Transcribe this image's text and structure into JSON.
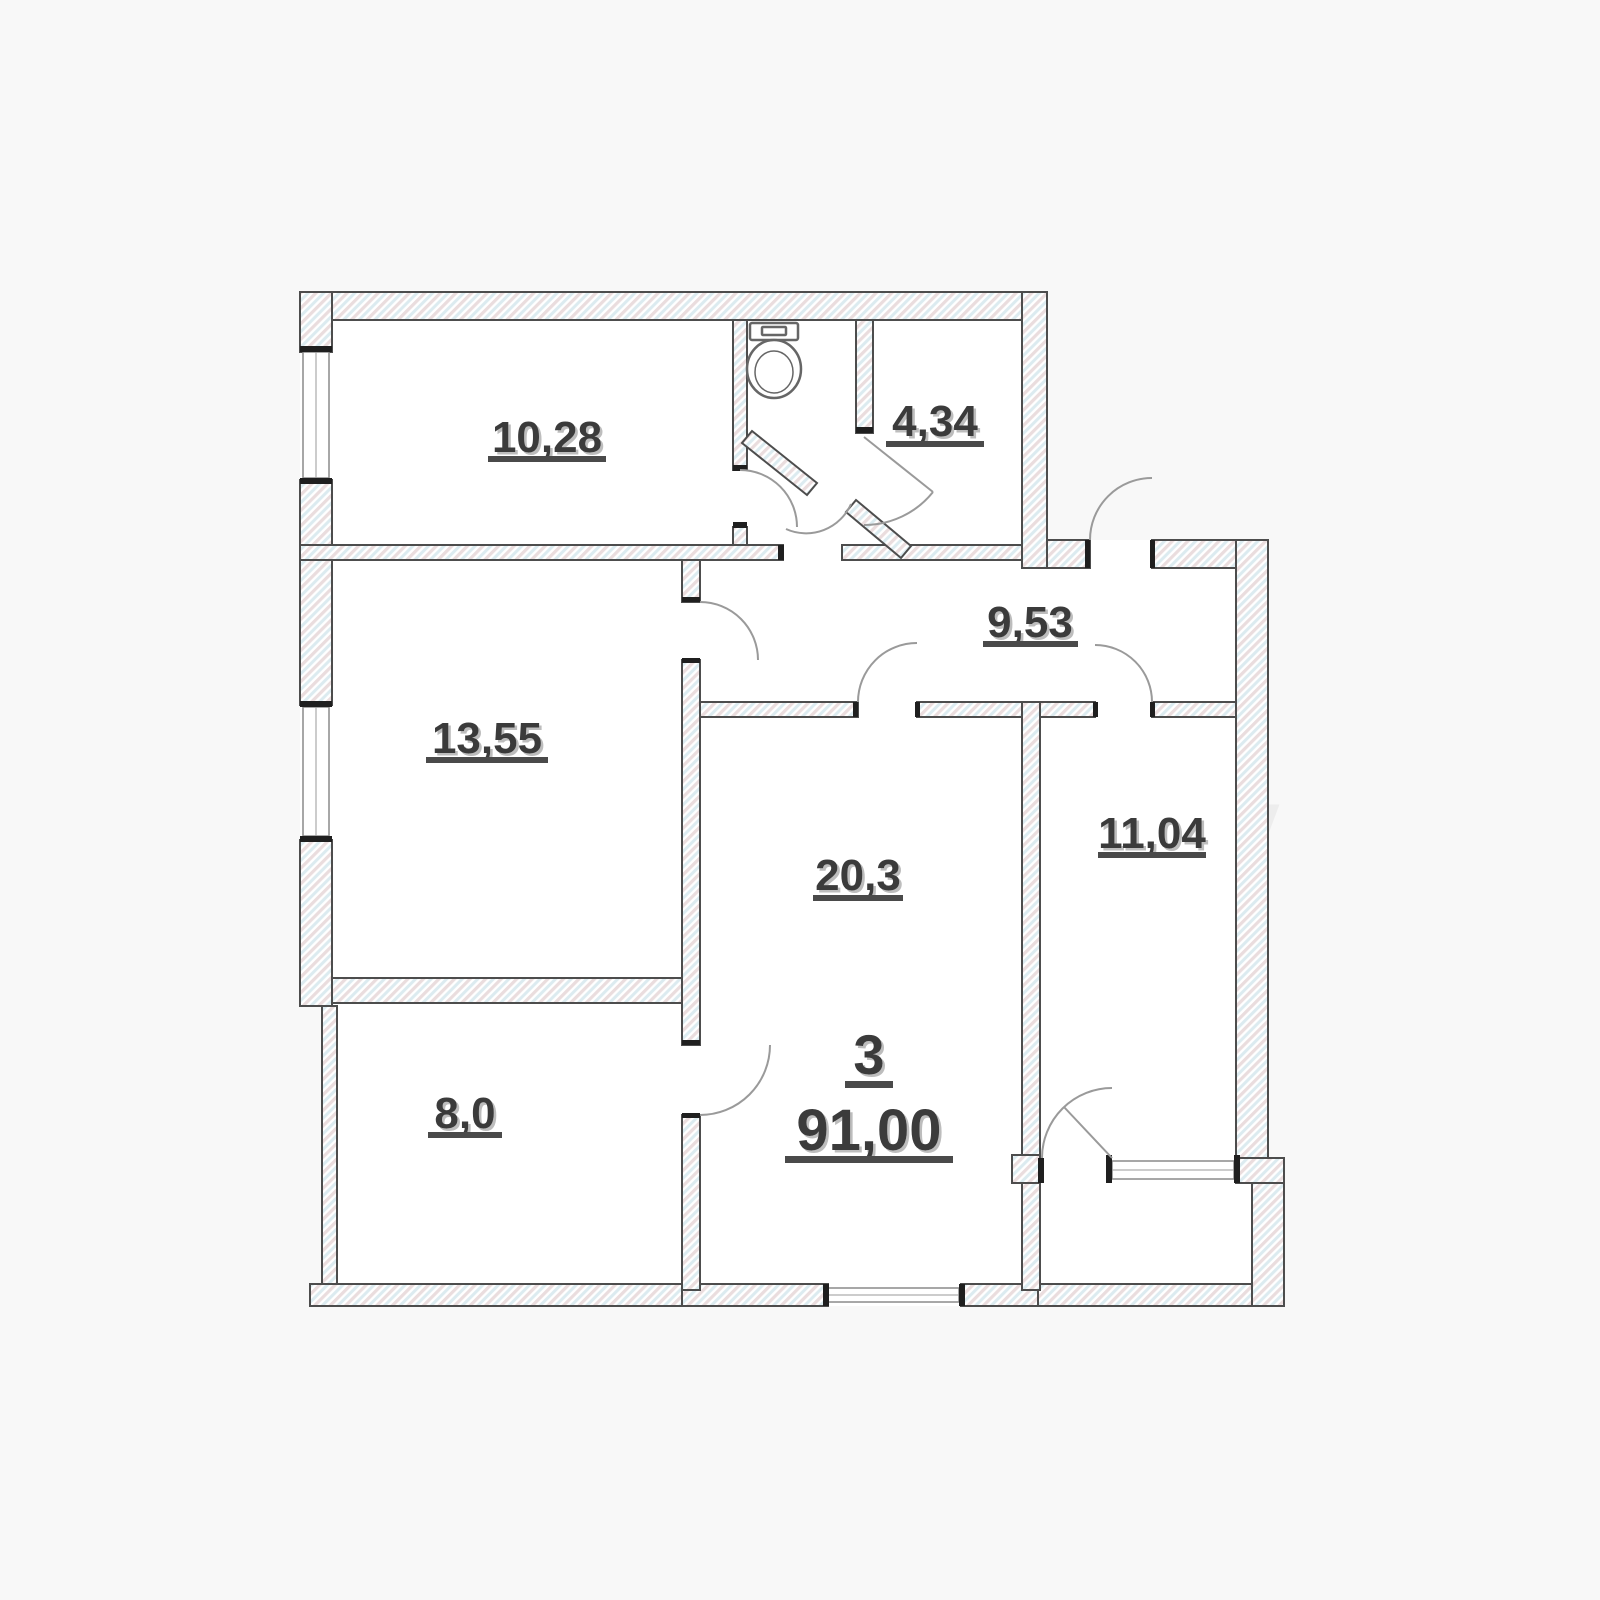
{
  "plan": {
    "apartment": {
      "number": "3",
      "total_area": "91,00"
    },
    "rooms": [
      {
        "key": "bedroom-top",
        "label": "10,28"
      },
      {
        "key": "bathroom",
        "label": "4,34"
      },
      {
        "key": "hallway",
        "label": "9,53"
      },
      {
        "key": "bedroom-left",
        "label": "13,55"
      },
      {
        "key": "living-room",
        "label": "20,3"
      },
      {
        "key": "bedroom-right",
        "label": "11,04"
      },
      {
        "key": "kitchen",
        "label": "8,0"
      }
    ],
    "watermark": {
      "text": "moby"
    },
    "colors": {
      "background": "#f8f8f8",
      "room_fill": "#ffffff",
      "wall_outline": "#4d4d4d",
      "hatch_pink": "#eaddde",
      "hatch_blue": "#dcebf0",
      "label_color": "#3a3a3a",
      "label_shadow": "#bdbdbd",
      "door_arc": "#9a9a9a",
      "jamb_black": "#1f1f1f"
    }
  }
}
